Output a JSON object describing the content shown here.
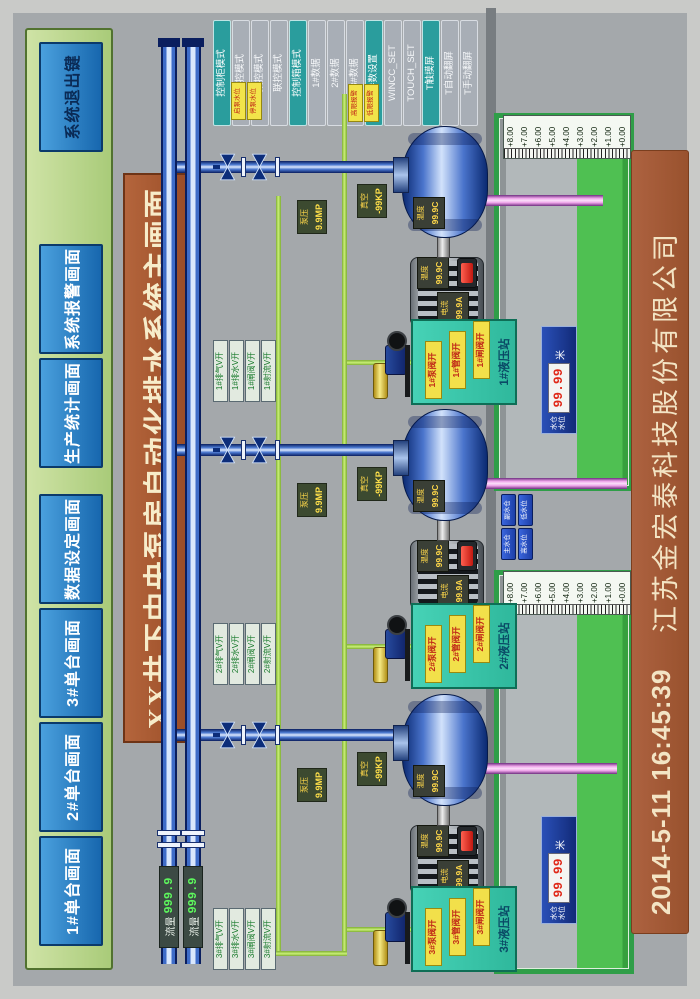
{
  "screen": {
    "title": "XX井下中央泵房自动化排水系统主画面"
  },
  "top_nav": {
    "buttons": [
      {
        "label": "1#单台画面"
      },
      {
        "label": "2#单台画面"
      },
      {
        "label": "3#单台画面"
      },
      {
        "label": "数据设定画面"
      },
      {
        "label": "生产统计画面"
      },
      {
        "label": "系统报警画面"
      },
      {
        "label": "系统退出键"
      }
    ]
  },
  "right_panel": {
    "buttons": [
      {
        "label": "控制柜模式"
      },
      {
        "label": "单控模式"
      },
      {
        "label": "集控模式"
      },
      {
        "label": "联控模式"
      },
      {
        "label": "控制箱模式"
      },
      {
        "label": "1#数据"
      },
      {
        "label": "2#数据"
      },
      {
        "label": "3#数据"
      },
      {
        "label": "参数设置"
      },
      {
        "label": "WINCC_SET"
      },
      {
        "label": "TOUCH_SET"
      },
      {
        "label": "T触摸屏"
      },
      {
        "label": "T自动翻屏"
      },
      {
        "label": "T手动翻屏"
      }
    ]
  },
  "status_tags": [
    {
      "label": "启泵水位"
    },
    {
      "label": "停泵水位"
    },
    {
      "label": "高限报警"
    },
    {
      "label": "低限报警"
    }
  ],
  "flow_meters": [
    {
      "label": "流量",
      "value": "999.9"
    },
    {
      "label": "流量",
      "value": "999.9"
    }
  ],
  "pumps": [
    {
      "id": "3#",
      "riser_valve_labels": [
        "3#排气V开",
        "3#排水V开",
        "3#闸阀V开",
        "3#射流V开"
      ],
      "pressure_tag": {
        "line1": "泵压",
        "line2": "9.9MP"
      },
      "vacuum_tag": {
        "line1": "真空",
        "line2": "-99KP"
      },
      "motor": {
        "current_label": "电流",
        "current_value": "99.9A",
        "temp_label": "温度",
        "temp_value": "99.9C"
      },
      "pump_label": {
        "temp_label": "温度",
        "temp_value": "99.9C"
      },
      "hydraulic": {
        "title": "3#液压站",
        "tags": [
          "3#泵阀开",
          "3#管阀开",
          "3#闸阀开"
        ]
      }
    },
    {
      "id": "2#",
      "riser_valve_labels": [
        "2#排气V开",
        "2#排水V开",
        "2#闸阀V开",
        "2#射流V开"
      ],
      "pressure_tag": {
        "line1": "泵压",
        "line2": "9.9MP"
      },
      "vacuum_tag": {
        "line1": "真空",
        "line2": "-99KP"
      },
      "motor": {
        "current_label": "电流",
        "current_value": "99.9A",
        "temp_label": "温度",
        "temp_value": "99.9C"
      },
      "pump_label": {
        "temp_label": "温度",
        "temp_value": "99.9C"
      },
      "hydraulic": {
        "title": "2#液压站",
        "tags": [
          "2#泵阀开",
          "2#管阀开",
          "2#闸阀开"
        ]
      }
    },
    {
      "id": "1#",
      "riser_valve_labels": [
        "1#排气V开",
        "1#排水V开",
        "1#闸阀V开",
        "1#射流V开"
      ],
      "pressure_tag": {
        "line1": "泵压",
        "line2": "9.9MP"
      },
      "vacuum_tag": {
        "line1": "真空",
        "line2": "-99KP"
      },
      "motor": {
        "current_label": "电流",
        "current_value": "99.9A",
        "temp_label": "温度",
        "temp_value": "99.9C"
      },
      "pump_label": {
        "temp_label": "温度",
        "temp_value": "99.9C"
      },
      "hydraulic": {
        "title": "1#液压站",
        "tags": [
          "1#泵阀开",
          "1#管阀开",
          "1#闸阀开"
        ]
      }
    }
  ],
  "sumps": [
    {
      "scale": [
        "+8.00",
        "+7.00",
        "+6.00",
        "+5.00",
        "+4.00",
        "+3.00",
        "+2.00",
        "+1.00",
        "+0.00"
      ],
      "panel": {
        "row1": "水仓",
        "row2": "水位",
        "value": "99.99",
        "unit": "米"
      }
    },
    {
      "scale": [
        "+8.00",
        "+7.00",
        "+6.00",
        "+5.00",
        "+4.00",
        "+3.00",
        "+2.00",
        "+1.00",
        "+0.00"
      ],
      "panel": {
        "row1": "水仓",
        "row2": "水位",
        "value": "99.99",
        "unit": "米"
      }
    }
  ],
  "sump_buttons": [
    {
      "label": "主水仓"
    },
    {
      "label": "副水仓"
    },
    {
      "label": "高水位"
    },
    {
      "label": "低水位"
    }
  ],
  "footer": {
    "timestamp": "2014-5-11  16:45:39",
    "company": "江苏金宏泰科技股份有限公司"
  },
  "colors": {
    "accent_teal": "#2a9d9d",
    "nav_blue": "#1b7fc4",
    "banner_brown": "#a8542c",
    "sump_green": "#2f9e48",
    "pipe_blue": "#3e6cc8",
    "alarm_red": "#e03020",
    "value_green": "#5df65d"
  }
}
